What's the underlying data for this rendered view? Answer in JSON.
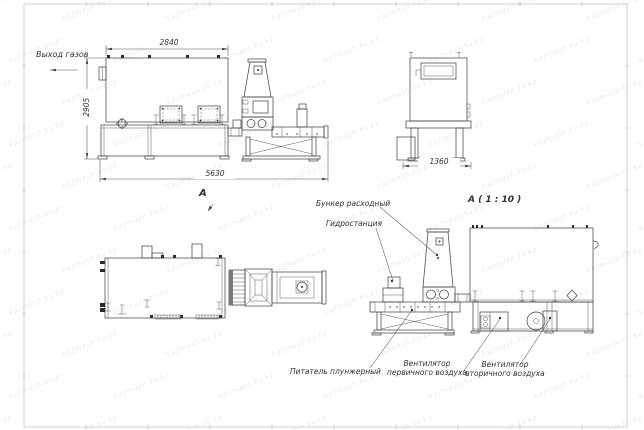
{
  "watermark": {
    "text": "kazmash.kv.kz"
  },
  "labels": {
    "gas_outlet": "Выход газов",
    "view_a": "А",
    "detail_a": "А ( 1 : 10 )",
    "hopper": "Бункер расходный",
    "hydro": "Гидростанция",
    "feeder": "Питатель плунжерный",
    "fan1_line1": "Вентилятор",
    "fan1_line2": "первичного воздуха",
    "fan2_line1": "Вентилятор",
    "fan2_line2": "вторичного воздуха"
  },
  "dimensions": {
    "top_width": "2840",
    "left_height": "2905",
    "total_length": "5630",
    "end_width": "1360"
  },
  "colors": {
    "line": "#474747",
    "dimension": "#555555",
    "background": "#ffffff",
    "border": "#b5b5b5",
    "watermark_text": "rgba(110,122,140,0.17)"
  }
}
